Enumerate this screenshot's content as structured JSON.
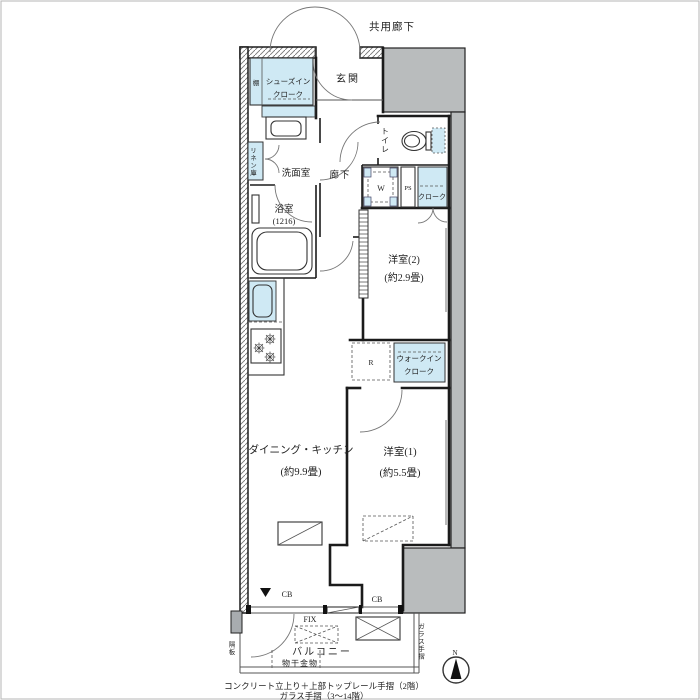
{
  "colors": {
    "light_blue": "#cfe9f4",
    "gray_mass": "#b9bcbd",
    "wall": "#1b1b1b",
    "text": "#222222"
  },
  "plan": {
    "type": "japanese-apartment-floorplan",
    "labels": {
      "common_corridor": "共用廊下",
      "entrance": "玄関",
      "shoe_closet_1": "シューズイン",
      "shoe_closet_2": "クローク",
      "shelf": "棚",
      "toilet": "トイレ",
      "washer": "W",
      "pipe_space": "PS",
      "cloak": "クローク",
      "linen_closet": "リネン庫",
      "washroom": "洗面室",
      "hallway": "廊下",
      "bathroom": "浴室",
      "bathroom_size": "(1216)",
      "western_room_2": "洋室(2)",
      "western_room_2_size": "(約2.9畳)",
      "refrigerator": "R",
      "walk_in_closet_1": "ウォークイン",
      "walk_in_closet_2": "クローク",
      "dining_kitchen": "ダイニング・キッチン",
      "dining_kitchen_size": "(約9.9畳)",
      "western_room_1": "洋室(1)",
      "western_room_1_size": "(約5.5畳)",
      "fix_window": "FIX",
      "balcony": "バルコニー",
      "laundry_hardware": "物干金物",
      "cb_left": "CB",
      "cb_right": "CB",
      "partition_board": "隔板",
      "glass_railing": "ガラス手摺",
      "compass_north": "N",
      "note_line1": "コンクリート立上り＋上部トップレール手摺（2階）",
      "note_line2": "ガラス手摺（3～14階）"
    }
  }
}
